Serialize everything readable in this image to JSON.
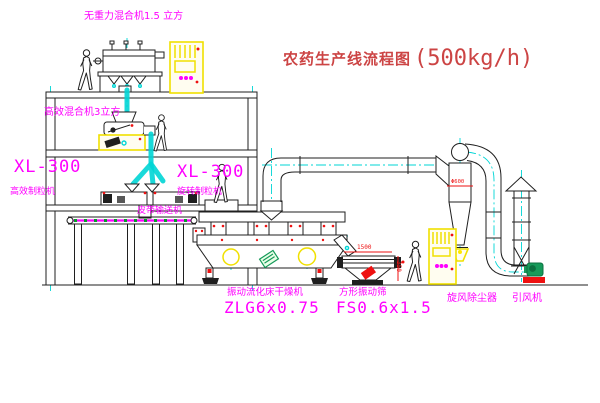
{
  "title": {
    "name": "农药生产线流程图",
    "capacity": "(500kg/h)"
  },
  "labels": {
    "gravity_mixer": "无重力混合机1.5 立方",
    "high_eff_mixer": "高效混合机3立方",
    "granulator_left_model": "XL-300",
    "granulator_left_name": "高效制粒机",
    "granulator_right_model": "XL-300",
    "granulator_right_name": "旋转制粒机",
    "belt_conveyor": "皮带输送机",
    "dryer_name": "振动流化床干燥机",
    "dryer_model": "ZLG6x0.75",
    "sieve_name": "方形振动筛",
    "sieve_model": "FS0.6x1.5",
    "cyclone": "旋风除尘器",
    "fan": "引风机"
  },
  "dimensions": {
    "sieve_length": "1500",
    "sieve_height": "350",
    "cyclone_diameter": "Φ600"
  },
  "colors": {
    "line": "#1f1f1f",
    "cyan": "#00d5d5",
    "magenta": "#ff00ff",
    "title_red": "#cc4444",
    "red": "#ee1111",
    "yellow": "#f0e000",
    "green": "#169a5a"
  }
}
